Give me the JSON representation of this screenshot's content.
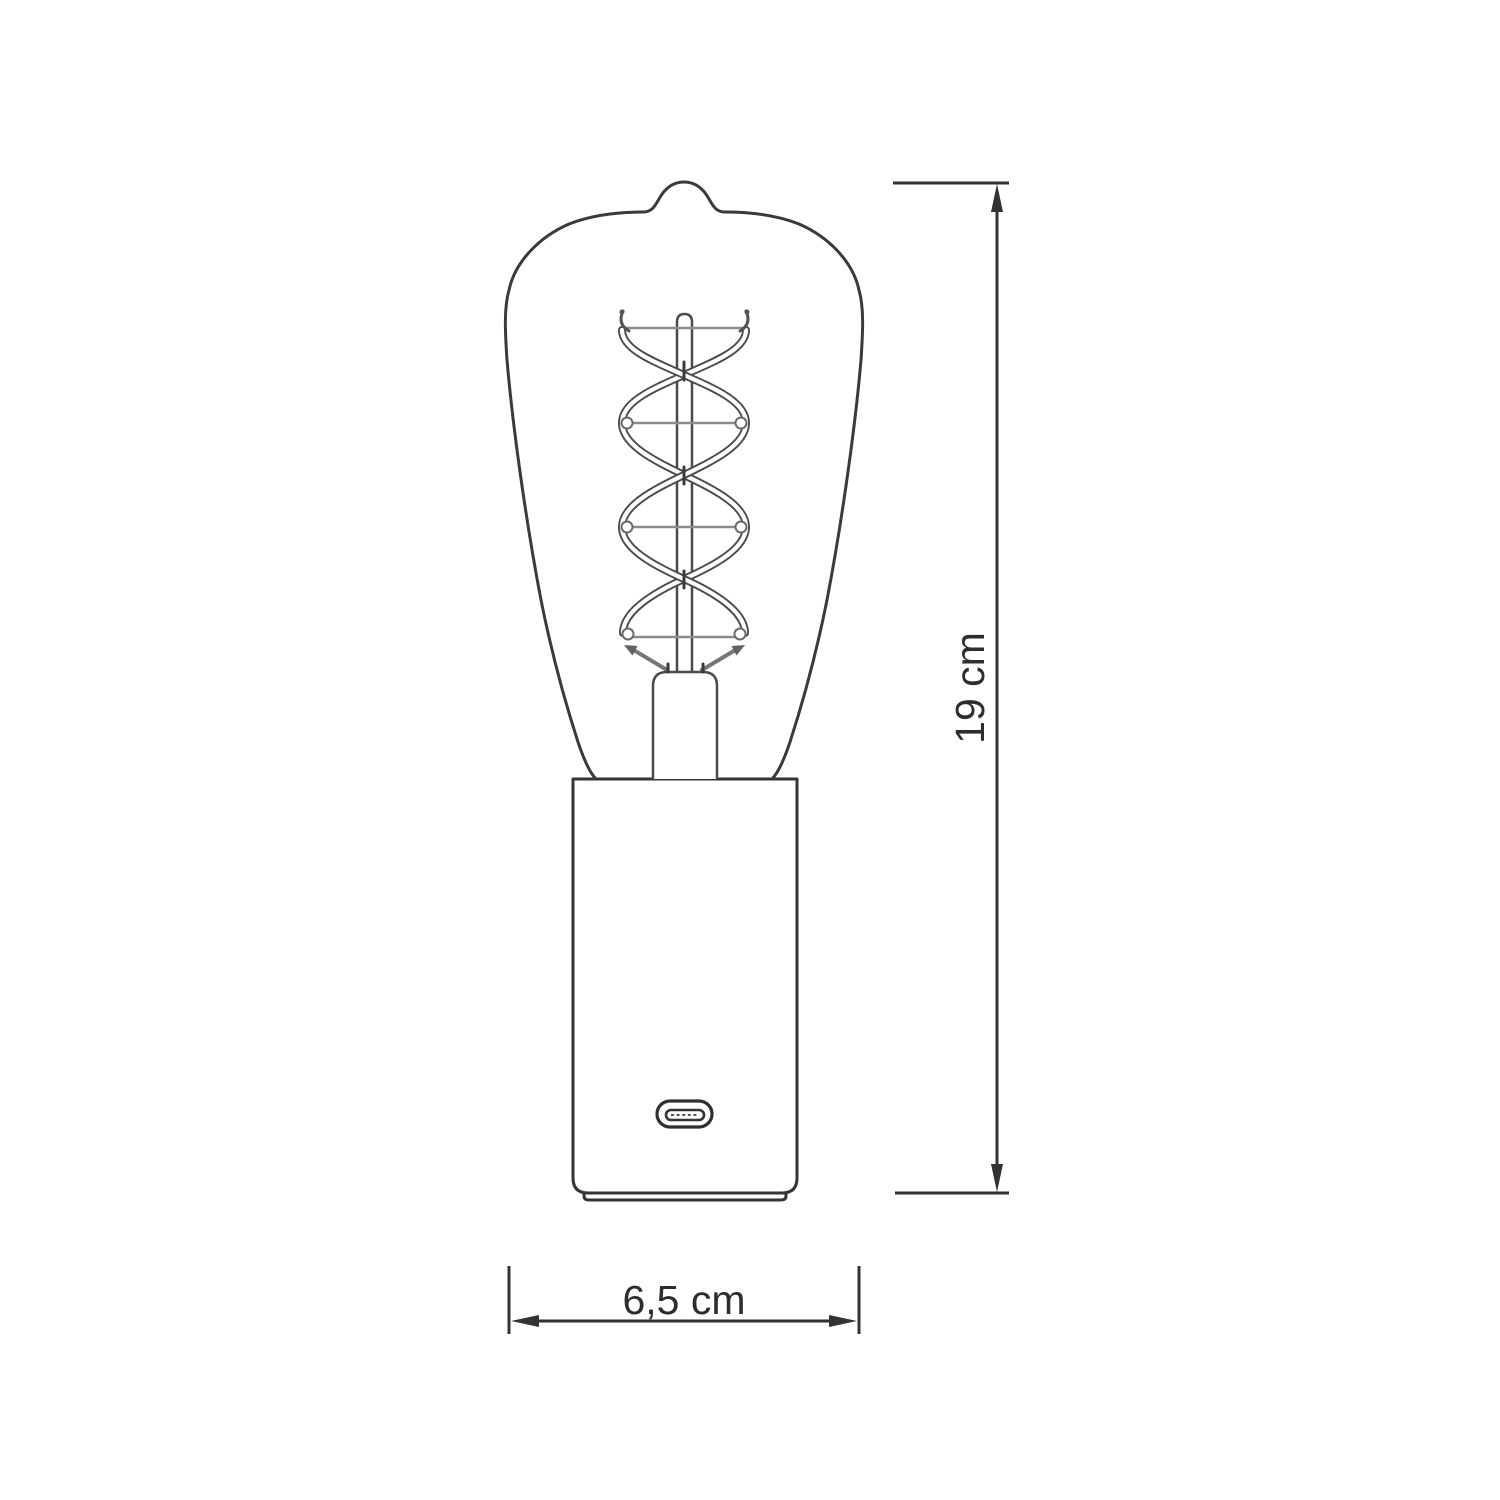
{
  "diagram": {
    "kind": "technical-dimension-drawing",
    "subject": "edison-bulb-table-lamp-with-usb-c-base"
  },
  "dimensions": {
    "height": {
      "label": "19 cm",
      "orientation": "vertical"
    },
    "width": {
      "label": "6,5 cm",
      "orientation": "horizontal"
    }
  },
  "components": [
    {
      "name": "st64-bulb-glass"
    },
    {
      "name": "spiral-double-helix-filament"
    },
    {
      "name": "glass-stem-rod"
    },
    {
      "name": "stem-press-mount"
    },
    {
      "name": "cylindrical-lamp-base"
    },
    {
      "name": "usb-c-port"
    }
  ],
  "colors": {
    "background": "#ffffff",
    "outline": "#3a3a3a",
    "filament_outline": "#4a4a4a",
    "support_wire": "#8c8c8c",
    "dimension_line": "#333333",
    "dimension_text": "#2d2d2d"
  }
}
